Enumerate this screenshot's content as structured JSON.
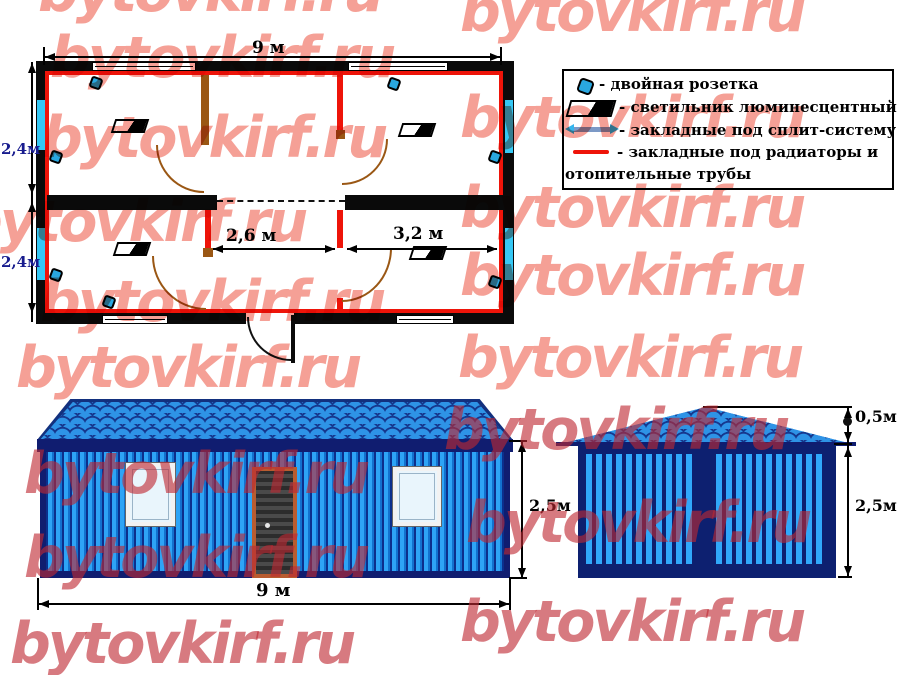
{
  "watermark": {
    "text": "bytovkirf.ru"
  },
  "floor_plan": {
    "width_dim": "9 м",
    "height_dim_top": "2,4м",
    "height_dim_bottom": "2,4м",
    "room_dim_middle": "2,6 м",
    "room_dim_right": "3,2 м"
  },
  "legend": {
    "items": [
      {
        "icon": "double-socket-icon",
        "label": "- двойная розетка"
      },
      {
        "icon": "fluorescent-light-icon",
        "label": "- светильник люминесцентный"
      },
      {
        "icon": "split-system-embed-icon",
        "label": "- закладные под сплит-систему"
      },
      {
        "icon": "radiator-embed-icon",
        "label": "- закладные под радиаторы  и",
        "label_line2": "отопительные трубы"
      }
    ]
  },
  "front_elevation": {
    "width_dim": "9 м",
    "height_dim": "2,5м"
  },
  "side_elevation": {
    "roof_height_dim": "0,5м",
    "wall_height_dim": "2,5м"
  },
  "colors": {
    "wall_blue": "#2ea4f6",
    "frame_navy": "#0d2070",
    "plan_red": "#ee1409",
    "embed_cyan": "#35c8f5",
    "door_brown": "#9a5714",
    "watermark_salmon": "#f5a096"
  }
}
